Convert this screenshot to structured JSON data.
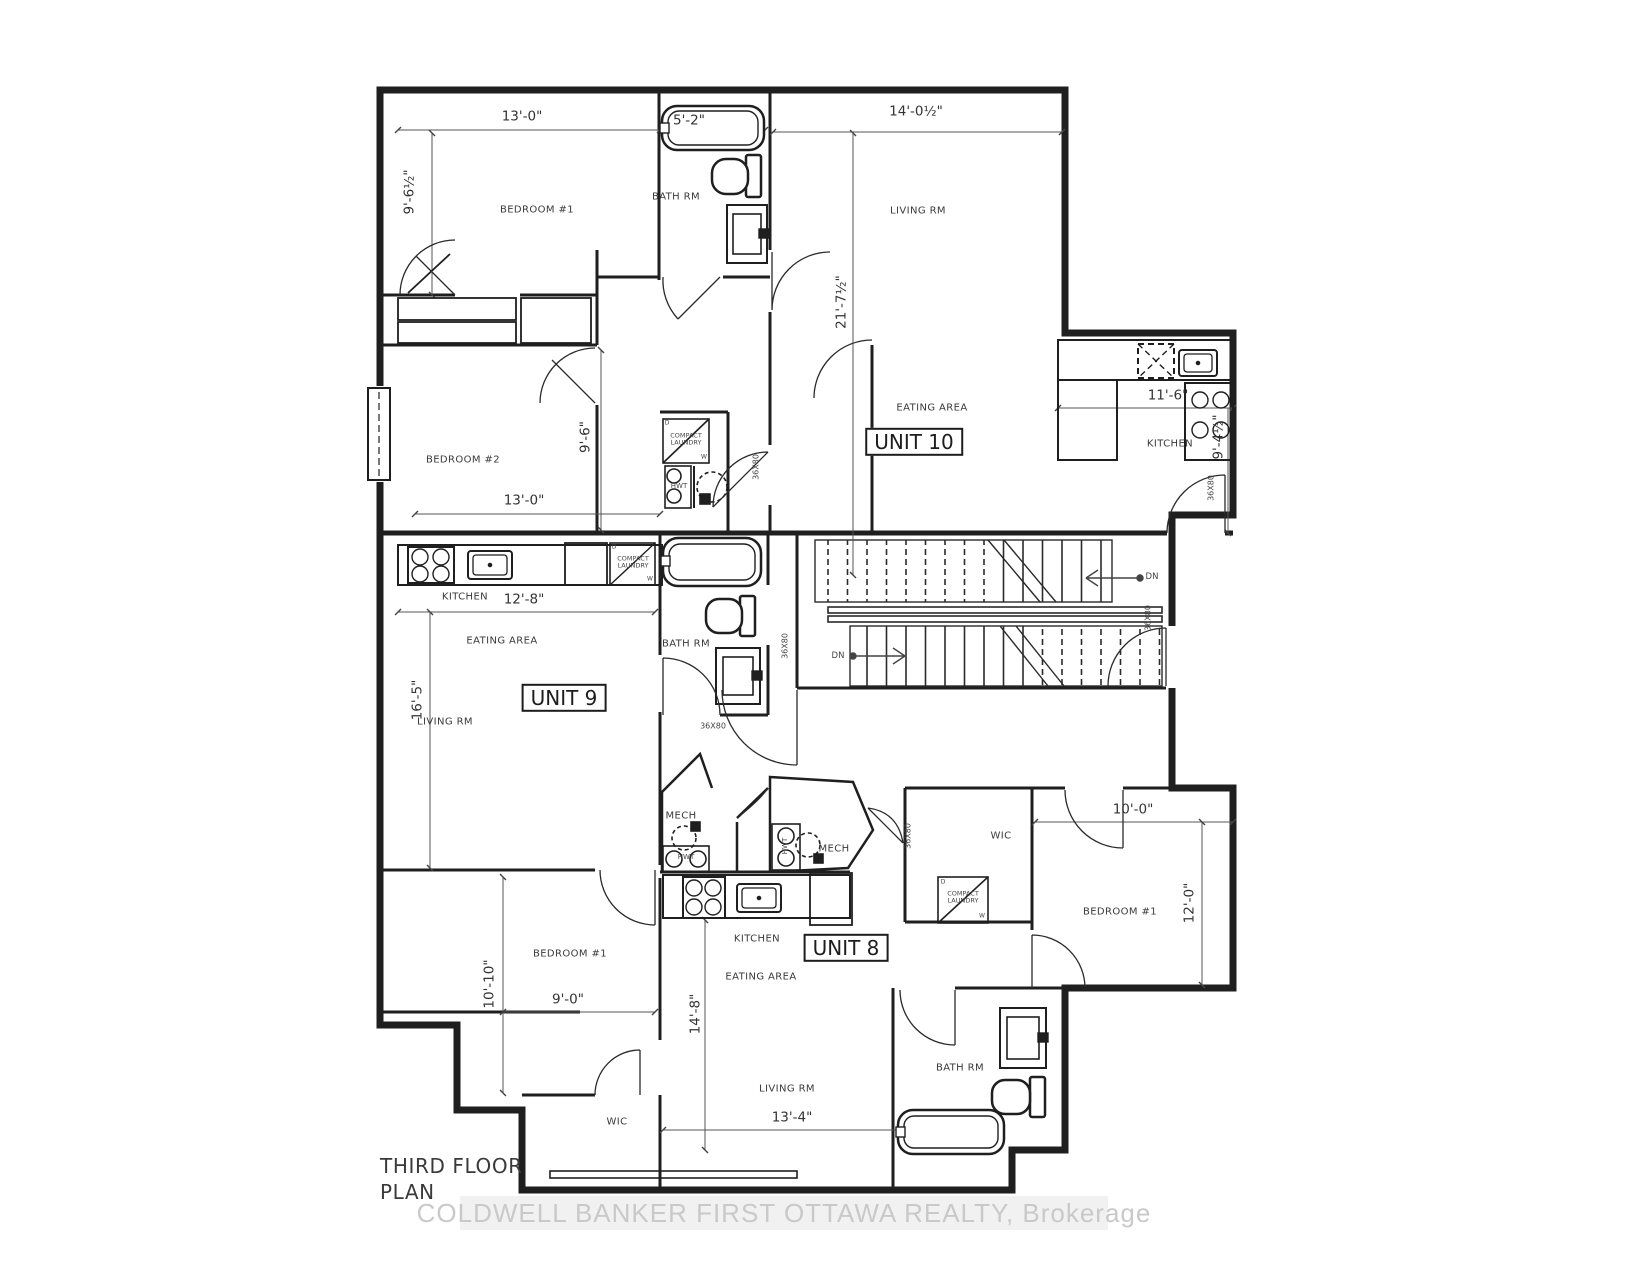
{
  "meta": {
    "drawing_title": "THIRD FLOOR PLAN",
    "units_shown": [
      "UNIT 8",
      "UNIT 9",
      "UNIT 10"
    ]
  },
  "colors": {
    "background": "#ffffff",
    "wall_line": "#1f1f1f",
    "dim_line": "#555555",
    "watermark_band": "#f1f1f1",
    "watermark_text": "#c9c9c9"
  },
  "watermark": {
    "text": "COLDWELL BANKER FIRST OTTAWA REALTY, Brokerage"
  },
  "labels": [
    {
      "name": "dim-13-0-top",
      "cls": "dim",
      "text": "13'-0\"",
      "x": 522,
      "y": 117
    },
    {
      "name": "dim-5-2-tub",
      "cls": "dim",
      "text": "5'-2\"",
      "x": 689,
      "y": 121
    },
    {
      "name": "dim-14-0half-top",
      "cls": "dim",
      "text": "14'-0½\"",
      "x": 916,
      "y": 112
    },
    {
      "name": "dim-9-6half-left",
      "cls": "dim rot",
      "text": "9'-6½\"",
      "x": 410,
      "y": 192,
      "rot": -90
    },
    {
      "name": "dim-21-7half",
      "cls": "dim rot",
      "text": "21'-7½\"",
      "x": 842,
      "y": 302,
      "rot": -90
    },
    {
      "name": "dim-11-6",
      "cls": "dim",
      "text": "11'-6\"",
      "x": 1168,
      "y": 396
    },
    {
      "name": "dim-9-4half",
      "cls": "dim rot",
      "text": "9'-4½\"",
      "x": 1219,
      "y": 437,
      "rot": -90
    },
    {
      "name": "dim-13-0-bed2",
      "cls": "dim",
      "text": "13'-0\"",
      "x": 524,
      "y": 501
    },
    {
      "name": "dim-9-6-bed2",
      "cls": "dim rot",
      "text": "9'-6\"",
      "x": 586,
      "y": 437,
      "rot": -90
    },
    {
      "name": "dim-12-8",
      "cls": "dim",
      "text": "12'-8\"",
      "x": 524,
      "y": 600
    },
    {
      "name": "dim-16-5",
      "cls": "dim rot",
      "text": "16'-5\"",
      "x": 418,
      "y": 700,
      "rot": -90
    },
    {
      "name": "dim-10-10",
      "cls": "dim rot",
      "text": "10'-10\"",
      "x": 490,
      "y": 984,
      "rot": -90
    },
    {
      "name": "dim-9-0",
      "cls": "dim",
      "text": "9'-0\"",
      "x": 568,
      "y": 1000
    },
    {
      "name": "dim-14-8",
      "cls": "dim rot",
      "text": "14'-8\"",
      "x": 696,
      "y": 1014,
      "rot": -90
    },
    {
      "name": "dim-13-4",
      "cls": "dim",
      "text": "13'-4\"",
      "x": 792,
      "y": 1118
    },
    {
      "name": "dim-10-0",
      "cls": "dim",
      "text": "10'-0\"",
      "x": 1133,
      "y": 810
    },
    {
      "name": "dim-12-0",
      "cls": "dim rot",
      "text": "12'-0\"",
      "x": 1190,
      "y": 903,
      "rot": -90
    },
    {
      "name": "room-bedroom1-top",
      "cls": "room",
      "text": "BEDROOM #1",
      "x": 537,
      "y": 210
    },
    {
      "name": "room-bathrm-top",
      "cls": "room",
      "text": "BATH RM",
      "x": 676,
      "y": 197
    },
    {
      "name": "room-livingrm-u10",
      "cls": "room",
      "text": "LIVING RM",
      "x": 918,
      "y": 211
    },
    {
      "name": "room-bedroom2",
      "cls": "room",
      "text": "BEDROOM #2",
      "x": 463,
      "y": 460
    },
    {
      "name": "room-eating-u10",
      "cls": "room",
      "text": "EATING AREA",
      "x": 932,
      "y": 408
    },
    {
      "name": "room-kitchen-u10",
      "cls": "room",
      "text": "KITCHEN",
      "x": 1170,
      "y": 444
    },
    {
      "name": "room-kitchen-u9",
      "cls": "room",
      "text": "KITCHEN",
      "x": 465,
      "y": 597
    },
    {
      "name": "room-eating-u9",
      "cls": "room",
      "text": "EATING AREA",
      "x": 502,
      "y": 641
    },
    {
      "name": "room-livingrm-u9",
      "cls": "room",
      "text": "LIVING RM",
      "x": 445,
      "y": 722
    },
    {
      "name": "room-bathrm-u9",
      "cls": "room",
      "text": "BATH RM",
      "x": 686,
      "y": 644
    },
    {
      "name": "room-mech-left",
      "cls": "room",
      "text": "MECH",
      "x": 681,
      "y": 816
    },
    {
      "name": "room-mech-right",
      "cls": "room",
      "text": "MECH",
      "x": 834,
      "y": 849
    },
    {
      "name": "room-kitchen-u8",
      "cls": "room",
      "text": "KITCHEN",
      "x": 757,
      "y": 939
    },
    {
      "name": "room-eating-u8",
      "cls": "room",
      "text": "EATING AREA",
      "x": 761,
      "y": 977
    },
    {
      "name": "room-wic-right",
      "cls": "room",
      "text": "WIC",
      "x": 1001,
      "y": 836
    },
    {
      "name": "room-bedroom1-right",
      "cls": "room",
      "text": "BEDROOM #1",
      "x": 1120,
      "y": 912
    },
    {
      "name": "room-bathrm-u8",
      "cls": "room",
      "text": "BATH RM",
      "x": 960,
      "y": 1068
    },
    {
      "name": "room-bedroom1-left",
      "cls": "room",
      "text": "BEDROOM #1",
      "x": 570,
      "y": 954
    },
    {
      "name": "room-wic-left",
      "cls": "room",
      "text": "WIC",
      "x": 617,
      "y": 1122
    },
    {
      "name": "room-livingrm-u8",
      "cls": "room",
      "text": "LIVING RM",
      "x": 787,
      "y": 1089
    },
    {
      "name": "unit-10-label",
      "cls": "unit",
      "text": "UNIT 10",
      "x": 914,
      "y": 442
    },
    {
      "name": "unit-9-label",
      "cls": "unit",
      "text": "UNIT 9",
      "x": 564,
      "y": 698
    },
    {
      "name": "unit-8-label",
      "cls": "unit",
      "text": "UNIT 8",
      "x": 846,
      "y": 948
    },
    {
      "name": "laundry-u10-label",
      "cls": "tiny",
      "text": "COMPACT\nLAUNDRY",
      "x": 686,
      "y": 440
    },
    {
      "name": "laundry-u9-label",
      "cls": "tiny",
      "text": "COMPACT\nLAUNDRY",
      "x": 633,
      "y": 563
    },
    {
      "name": "laundry-u8-label",
      "cls": "tiny",
      "text": "COMPACT\nLAUNDRY",
      "x": 963,
      "y": 898
    },
    {
      "name": "laundry-u10-d",
      "cls": "micro",
      "text": "D",
      "x": 667,
      "y": 424
    },
    {
      "name": "laundry-u10-w",
      "cls": "micro",
      "text": "W",
      "x": 704,
      "y": 458
    },
    {
      "name": "laundry-u9-d",
      "cls": "micro",
      "text": "D",
      "x": 614,
      "y": 548
    },
    {
      "name": "laundry-u9-w",
      "cls": "micro",
      "text": "W",
      "x": 650,
      "y": 580
    },
    {
      "name": "laundry-u8-d",
      "cls": "micro",
      "text": "D",
      "x": 943,
      "y": 883
    },
    {
      "name": "laundry-u8-w",
      "cls": "micro",
      "text": "W",
      "x": 982,
      "y": 917
    },
    {
      "name": "hwt-u10-label",
      "cls": "hwt",
      "text": "HWT",
      "x": 679,
      "y": 487
    },
    {
      "name": "hwt-mech-left",
      "cls": "hwt",
      "text": "HWT",
      "x": 686,
      "y": 858
    },
    {
      "name": "hwt-mech-right",
      "cls": "hwt rot",
      "text": "HWT",
      "x": 786,
      "y": 846,
      "rot": -90
    },
    {
      "name": "door-36x80-hall9",
      "cls": "door rot",
      "text": "36X80",
      "x": 757,
      "y": 467,
      "rot": -90
    },
    {
      "name": "door-36x80-kit10",
      "cls": "door rot",
      "text": "36X80",
      "x": 1212,
      "y": 488,
      "rot": -90
    },
    {
      "name": "door-36x80-hall8",
      "cls": "door rot",
      "text": "36X80",
      "x": 1149,
      "y": 618,
      "rot": -90
    },
    {
      "name": "door-36x80-bath9r",
      "cls": "door rot",
      "text": "36X80",
      "x": 786,
      "y": 646,
      "rot": -90
    },
    {
      "name": "door-36x80-bath9b",
      "cls": "door",
      "text": "36X80",
      "x": 713,
      "y": 727
    },
    {
      "name": "door-36x80-wic8",
      "cls": "door rot",
      "text": "36X80",
      "x": 909,
      "y": 836,
      "rot": -90
    },
    {
      "name": "stair-dn-upper",
      "cls": "stairlbl",
      "text": "DN",
      "x": 1152,
      "y": 578
    },
    {
      "name": "stair-dn-lower",
      "cls": "stairlbl",
      "text": "DN",
      "x": 838,
      "y": 657
    },
    {
      "name": "plan-title-line1",
      "cls": "title",
      "text": "THIRD FLOOR",
      "x": 380,
      "y": 1166
    },
    {
      "name": "plan-title-line2",
      "cls": "title",
      "text": "PLAN",
      "x": 380,
      "y": 1192
    }
  ]
}
